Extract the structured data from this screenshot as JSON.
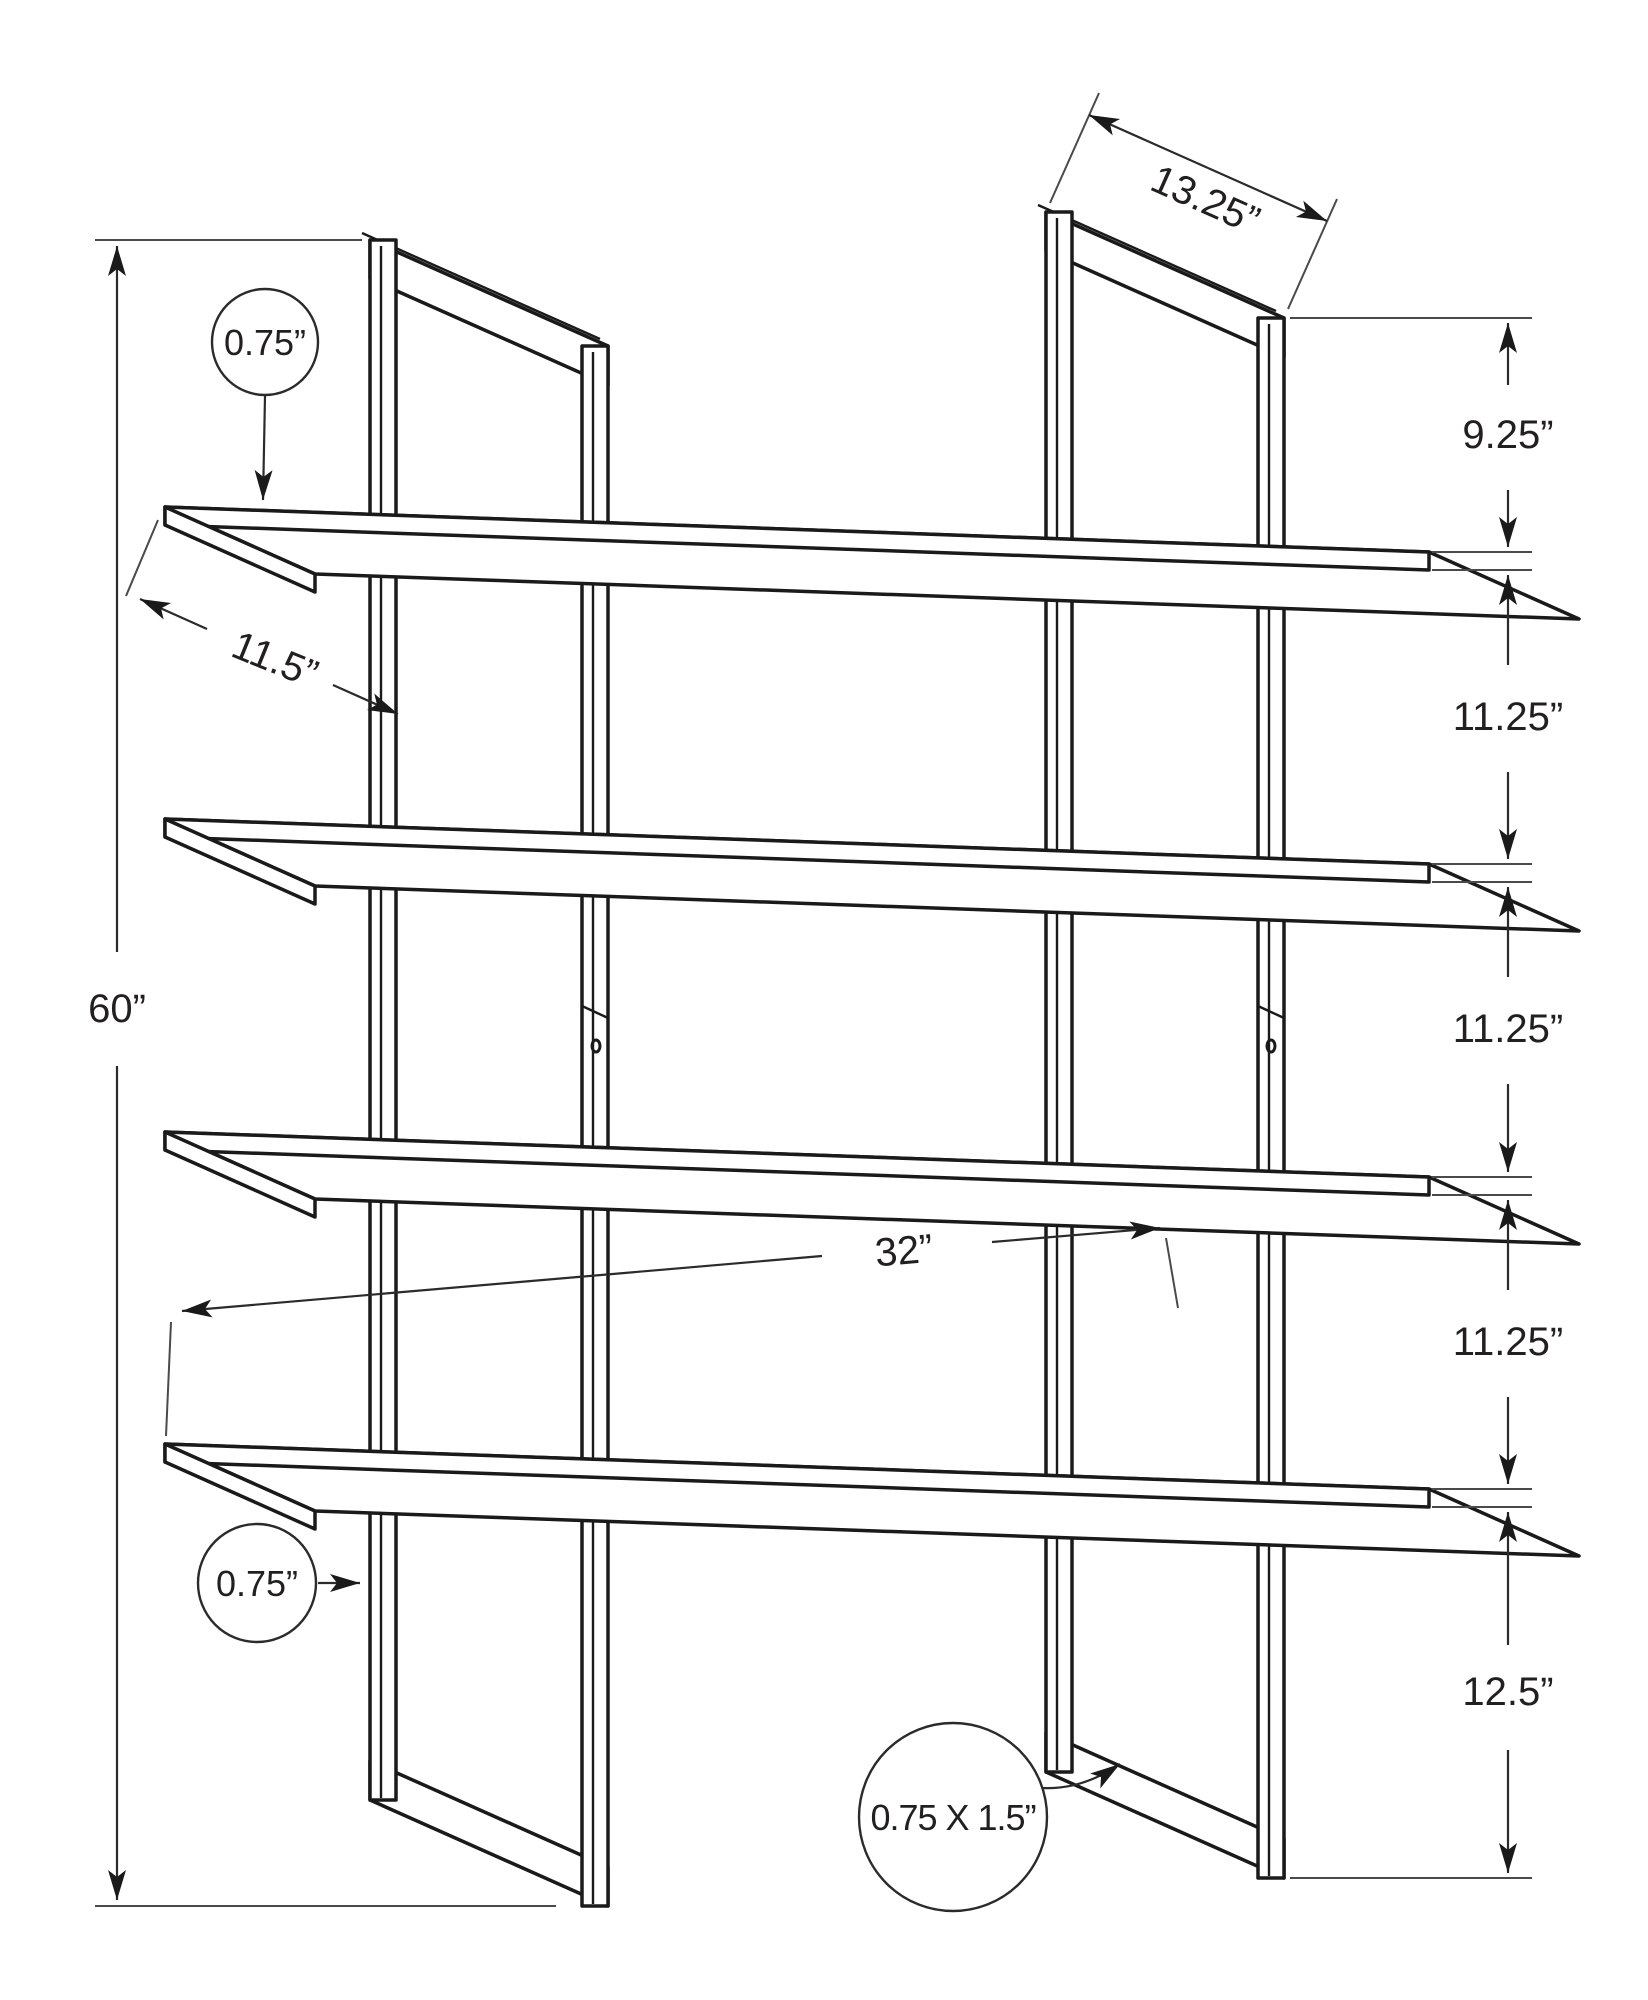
{
  "figure": {
    "kind": "product dimension diagram",
    "subject": "60 inch high 4-shelf etagere bookcase with metal frame"
  },
  "dimensions": {
    "top_depth": "13.25”",
    "right_chain": [
      "9.25”",
      "11.25”",
      "11.25”",
      "11.25”",
      "12.5”"
    ],
    "overall_height": "60”",
    "shelf_thickness": "0.75”",
    "shelf_depth": "11.5”",
    "shelf_span": "32”",
    "post_width": "0.75”",
    "frame_tube": "0.75 X 1.5”"
  }
}
